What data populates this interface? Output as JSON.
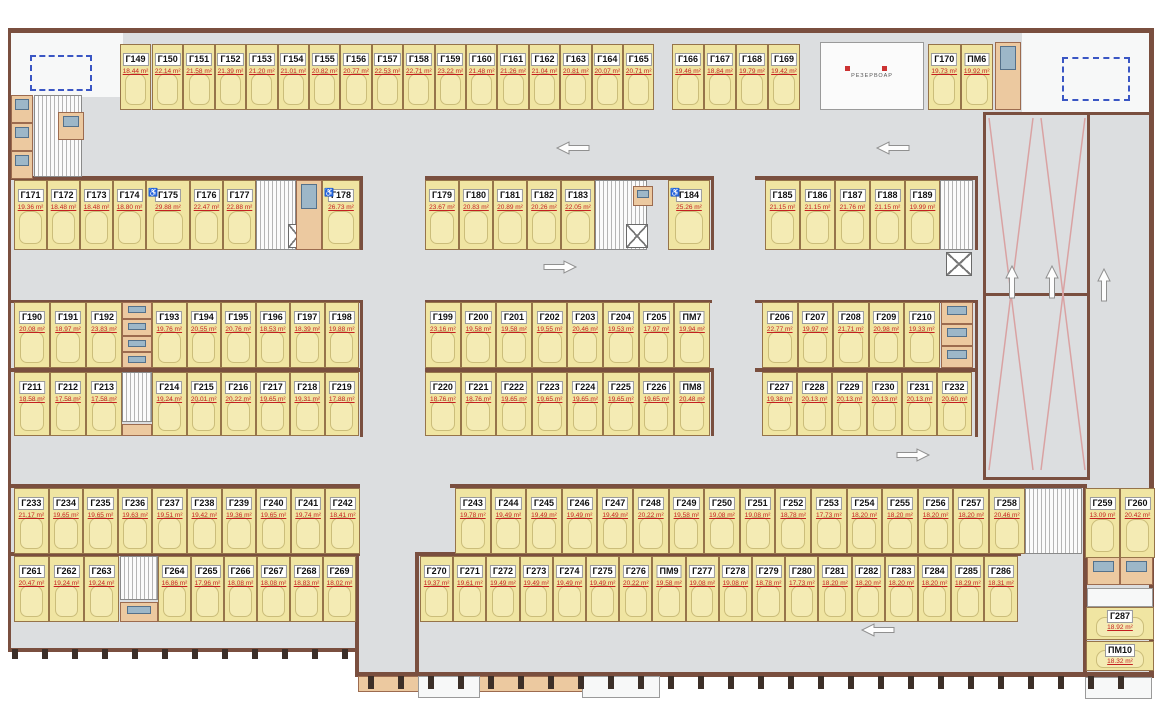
{
  "rooms": {
    "reservoir_label": "РЕЗЕРВОАР"
  },
  "colors": {
    "stall_fill": "#f0e5a2",
    "area_text": "#c42020",
    "wall": "#7a4f3f",
    "dashed_box": "#3a56c4",
    "aisle": "#dcdee0"
  },
  "groups": [
    {
      "name": "row1-left",
      "stalls": [
        {
          "id": "Г149",
          "area": "18.44 m²"
        }
      ]
    },
    {
      "name": "row1-main",
      "stalls": [
        {
          "id": "Г150",
          "area": "22.14 m²"
        },
        {
          "id": "Г151",
          "area": "21.58 m²"
        },
        {
          "id": "Г152",
          "area": "21.39 m²"
        },
        {
          "id": "Г153",
          "area": "21.20 m²"
        },
        {
          "id": "Г154",
          "area": "21.01 m²"
        },
        {
          "id": "Г155",
          "area": "20.82 m²"
        },
        {
          "id": "Г156",
          "area": "20.77 m²"
        },
        {
          "id": "Г157",
          "area": "22.53 m²"
        },
        {
          "id": "Г158",
          "area": "22.71 m²"
        },
        {
          "id": "Г159",
          "area": "23.22 m²"
        },
        {
          "id": "Г160",
          "area": "21.48 m²"
        },
        {
          "id": "Г161",
          "area": "21.26 m²"
        },
        {
          "id": "Г162",
          "area": "21.04 m²"
        },
        {
          "id": "Г163",
          "area": "20.81 m²"
        },
        {
          "id": "Г164",
          "area": "20.07 m²"
        },
        {
          "id": "Г165",
          "area": "20.71 m²"
        }
      ]
    },
    {
      "name": "row1-mid",
      "stalls": [
        {
          "id": "Г166",
          "area": "19.46 m²"
        },
        {
          "id": "Г167",
          "area": "18.84 m²"
        },
        {
          "id": "Г168",
          "area": "19.79 m²"
        },
        {
          "id": "Г169",
          "area": "19.42 m²"
        }
      ]
    },
    {
      "name": "row1-right",
      "stalls": [
        {
          "id": "Г170",
          "area": "19.73 m²"
        },
        {
          "id": "ПМ6",
          "area": "19.92 m²"
        }
      ]
    },
    {
      "name": "row2-left",
      "stalls": [
        {
          "id": "Г171",
          "area": "19.36 m²"
        },
        {
          "id": "Г172",
          "area": "18.48 m²"
        },
        {
          "id": "Г173",
          "area": "18.48 m²"
        },
        {
          "id": "Г174",
          "area": "18.80 m²"
        },
        {
          "id": "Г175",
          "area": "29.88 m²",
          "acc": true
        },
        {
          "id": "Г176",
          "area": "22.47 m²"
        },
        {
          "id": "Г177",
          "area": "22.88 m²"
        }
      ]
    },
    {
      "name": "row2-left-end",
      "stalls": [
        {
          "id": "Г178",
          "area": "26.73 m²",
          "acc": true
        }
      ]
    },
    {
      "name": "row2-mid",
      "stalls": [
        {
          "id": "Г179",
          "area": "23.67 m²"
        },
        {
          "id": "Г180",
          "area": "20.83 m²"
        },
        {
          "id": "Г181",
          "area": "20.89 m²"
        },
        {
          "id": "Г182",
          "area": "20.26 m²"
        },
        {
          "id": "Г183",
          "area": "22.05 m²"
        }
      ]
    },
    {
      "name": "row2-mid-end",
      "stalls": [
        {
          "id": "Г184",
          "area": "25.26 m²",
          "acc": true
        }
      ]
    },
    {
      "name": "row2-right",
      "stalls": [
        {
          "id": "Г185",
          "area": "21.15 m²"
        },
        {
          "id": "Г186",
          "area": "21.15 m²"
        },
        {
          "id": "Г187",
          "area": "21.76 m²"
        },
        {
          "id": "Г188",
          "area": "21.15 m²"
        },
        {
          "id": "Г189",
          "area": "19.99 m²"
        }
      ]
    },
    {
      "name": "row3-left-a",
      "stalls": [
        {
          "id": "Г190",
          "area": "20.08 m²"
        },
        {
          "id": "Г191",
          "area": "18.97 m²"
        },
        {
          "id": "Г192",
          "area": "23.83 m²"
        }
      ]
    },
    {
      "name": "row3-left-b",
      "stalls": [
        {
          "id": "Г193",
          "area": "19.76 m²"
        },
        {
          "id": "Г194",
          "area": "20.55 m²"
        },
        {
          "id": "Г195",
          "area": "20.76 m²"
        },
        {
          "id": "Г196",
          "area": "18.53 m²"
        },
        {
          "id": "Г197",
          "area": "18.39 m²"
        },
        {
          "id": "Г198",
          "area": "19.88 m²"
        }
      ]
    },
    {
      "name": "row3-mid",
      "stalls": [
        {
          "id": "Г199",
          "area": "23.16 m²"
        },
        {
          "id": "Г200",
          "area": "19.58 m²"
        },
        {
          "id": "Г201",
          "area": "19.58 m²"
        },
        {
          "id": "Г202",
          "area": "19.55 m²"
        },
        {
          "id": "Г203",
          "area": "20.46 m²"
        },
        {
          "id": "Г204",
          "area": "19.53 m²"
        },
        {
          "id": "Г205",
          "area": "17.97 m²"
        },
        {
          "id": "ПМ7",
          "area": "19.94 m²"
        }
      ]
    },
    {
      "name": "row3-right",
      "stalls": [
        {
          "id": "Г206",
          "area": "22.77 m²"
        },
        {
          "id": "Г207",
          "area": "19.97 m²"
        },
        {
          "id": "Г208",
          "area": "21.71 m²"
        },
        {
          "id": "Г209",
          "area": "20.98 m²"
        },
        {
          "id": "Г210",
          "area": "19.33 m²"
        }
      ]
    },
    {
      "name": "row4-left-a",
      "stalls": [
        {
          "id": "Г211",
          "area": "18.58 m²"
        },
        {
          "id": "Г212",
          "area": "17.58 m²"
        },
        {
          "id": "Г213",
          "area": "17.58 m²"
        }
      ]
    },
    {
      "name": "row4-left-b",
      "stalls": [
        {
          "id": "Г214",
          "area": "19.24 m²"
        },
        {
          "id": "Г215",
          "area": "20.01 m²"
        },
        {
          "id": "Г216",
          "area": "20.22 m²"
        },
        {
          "id": "Г217",
          "area": "19.65 m²"
        },
        {
          "id": "Г218",
          "area": "19.31 m²"
        },
        {
          "id": "Г219",
          "area": "17.88 m²"
        }
      ]
    },
    {
      "name": "row4-mid",
      "stalls": [
        {
          "id": "Г220",
          "area": "18.76 m²"
        },
        {
          "id": "Г221",
          "area": "18.76 m²"
        },
        {
          "id": "Г222",
          "area": "19.65 m²"
        },
        {
          "id": "Г223",
          "area": "19.65 m²"
        },
        {
          "id": "Г224",
          "area": "19.65 m²"
        },
        {
          "id": "Г225",
          "area": "19.65 m²"
        },
        {
          "id": "Г226",
          "area": "19.65 m²"
        },
        {
          "id": "ПМ8",
          "area": "20.48 m²"
        }
      ]
    },
    {
      "name": "row4-right",
      "stalls": [
        {
          "id": "Г227",
          "area": "19.38 m²"
        },
        {
          "id": "Г228",
          "area": "20.13 m²"
        },
        {
          "id": "Г229",
          "area": "20.13 m²"
        },
        {
          "id": "Г230",
          "area": "20.13 m²"
        },
        {
          "id": "Г231",
          "area": "20.13 m²"
        },
        {
          "id": "Г232",
          "area": "20.60 m²"
        }
      ]
    },
    {
      "name": "row5-left",
      "stalls": [
        {
          "id": "Г233",
          "area": "21.17 m²"
        },
        {
          "id": "Г234",
          "area": "19.65 m²"
        },
        {
          "id": "Г235",
          "area": "19.65 m²"
        },
        {
          "id": "Г236",
          "area": "19.63 m²"
        },
        {
          "id": "Г237",
          "area": "19.51 m²"
        },
        {
          "id": "Г238",
          "area": "19.42 m²"
        },
        {
          "id": "Г239",
          "area": "19.36 m²"
        },
        {
          "id": "Г240",
          "area": "19.65 m²"
        },
        {
          "id": "Г241",
          "area": "19.74 m²"
        },
        {
          "id": "Г242",
          "area": "18.41 m²"
        }
      ]
    },
    {
      "name": "row5-mid",
      "stalls": [
        {
          "id": "Г243",
          "area": "19.78 m²"
        },
        {
          "id": "Г244",
          "area": "19.49 m²"
        },
        {
          "id": "Г245",
          "area": "19.49 m²"
        },
        {
          "id": "Г246",
          "area": "19.49 m²"
        },
        {
          "id": "Г247",
          "area": "19.49 m²"
        },
        {
          "id": "Г248",
          "area": "20.22 m²"
        },
        {
          "id": "Г249",
          "area": "19.58 m²"
        },
        {
          "id": "Г250",
          "area": "19.08 m²"
        },
        {
          "id": "Г251",
          "area": "19.08 m²"
        },
        {
          "id": "Г252",
          "area": "18.78 m²"
        },
        {
          "id": "Г253",
          "area": "17.73 m²"
        },
        {
          "id": "Г254",
          "area": "18.20 m²"
        },
        {
          "id": "Г255",
          "area": "18.20 m²"
        },
        {
          "id": "Г256",
          "area": "18.20 m²"
        },
        {
          "id": "Г257",
          "area": "18.20 m²"
        },
        {
          "id": "Г258",
          "area": "20.46 m²"
        }
      ]
    },
    {
      "name": "row5-right",
      "stalls": [
        {
          "id": "Г259",
          "area": "13.09 m²"
        },
        {
          "id": "Г260",
          "area": "20.42 m²"
        }
      ]
    },
    {
      "name": "row6-left-a",
      "stalls": [
        {
          "id": "Г261",
          "area": "20.47 m²"
        },
        {
          "id": "Г262",
          "area": "19.24 m²"
        },
        {
          "id": "Г263",
          "area": "19.24 m²"
        }
      ]
    },
    {
      "name": "row6-left-b",
      "stalls": [
        {
          "id": "Г264",
          "area": "16.86 m²"
        },
        {
          "id": "Г265",
          "area": "17.96 m²"
        },
        {
          "id": "Г266",
          "area": "18.08 m²"
        },
        {
          "id": "Г267",
          "area": "18.08 m²"
        },
        {
          "id": "Г268",
          "area": "18.83 m²"
        },
        {
          "id": "Г269",
          "area": "18.02 m²"
        }
      ]
    },
    {
      "name": "row6-mid",
      "stalls": [
        {
          "id": "Г270",
          "area": "19.37 m²"
        },
        {
          "id": "Г271",
          "area": "19.61 m²"
        },
        {
          "id": "Г272",
          "area": "19.49 m²"
        },
        {
          "id": "Г273",
          "area": "19.49 m²"
        },
        {
          "id": "Г274",
          "area": "19.49 m²"
        },
        {
          "id": "Г275",
          "area": "19.49 m²"
        },
        {
          "id": "Г276",
          "area": "20.22 m²"
        },
        {
          "id": "ПМ9",
          "area": "19.58 m²"
        },
        {
          "id": "Г277",
          "area": "19.08 m²"
        },
        {
          "id": "Г278",
          "area": "19.08 m²"
        },
        {
          "id": "Г279",
          "area": "18.78 m²"
        },
        {
          "id": "Г280",
          "area": "17.73 m²"
        },
        {
          "id": "Г281",
          "area": "18.20 m²"
        },
        {
          "id": "Г282",
          "area": "18.20 m²"
        },
        {
          "id": "Г283",
          "area": "18.20 m²"
        },
        {
          "id": "Г284",
          "area": "18.20 m²"
        },
        {
          "id": "Г285",
          "area": "18.29 m²"
        },
        {
          "id": "Г286",
          "area": "18.31 m²"
        }
      ]
    },
    {
      "name": "corner",
      "stalls": [
        {
          "id": "Г287",
          "area": "18.92 m²"
        },
        {
          "id": "ПМ10",
          "area": "18.32 m²"
        }
      ]
    }
  ]
}
